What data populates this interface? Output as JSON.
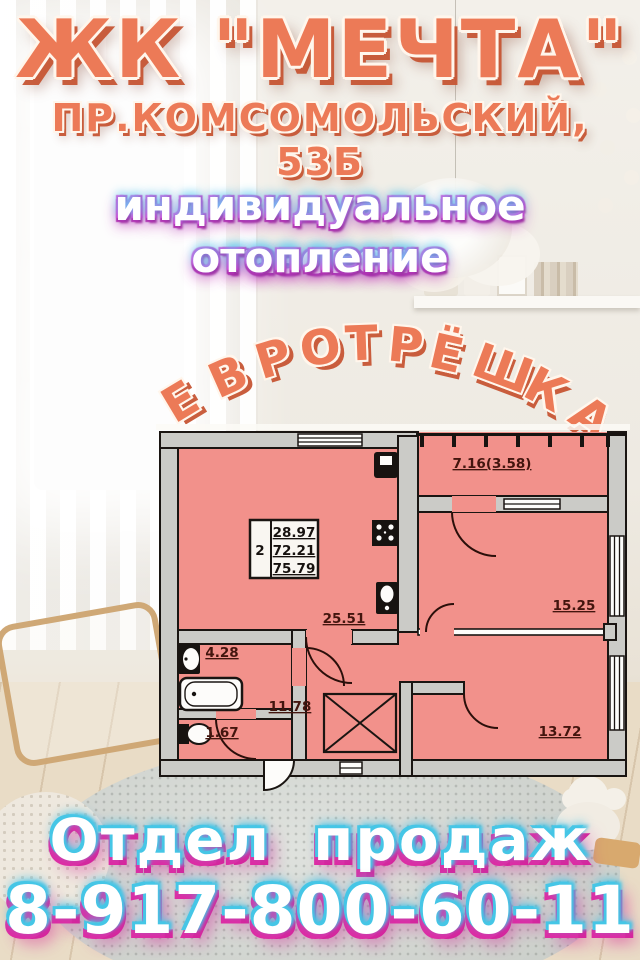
{
  "header": {
    "complex_name": "ЖК \"МЕЧТА\"",
    "address": "ПР.КОМСОМОЛЬСКИЙ, 53Б",
    "feature_line1": "индивидуальное газовое",
    "feature_line2": "отопление",
    "arch_text": "ЕВРОТРЁШКА"
  },
  "floor_plan": {
    "spec": {
      "rooms": "2",
      "areas": [
        "28.97",
        "72.21",
        "75.79"
      ]
    },
    "labels": {
      "balcony": "7.16(3.58)",
      "kitchen_living": "25.51",
      "bedroom_right": "15.25",
      "bedroom_bottom": "13.72",
      "hall": "11.78",
      "bathroom": "4.28",
      "wc": "1.67"
    }
  },
  "footer": {
    "sales_label": "Отдел продаж",
    "phone": "8-917-800-60-11"
  },
  "colors": {
    "coral": "#ec7a57",
    "coral_shadow": "#c4532f",
    "glow_magenta": "#d92bba",
    "glow_cyan": "#3fc9e8",
    "plan_room_pink": "#f2918b",
    "plan_wall_gray": "#cbcbc7"
  }
}
